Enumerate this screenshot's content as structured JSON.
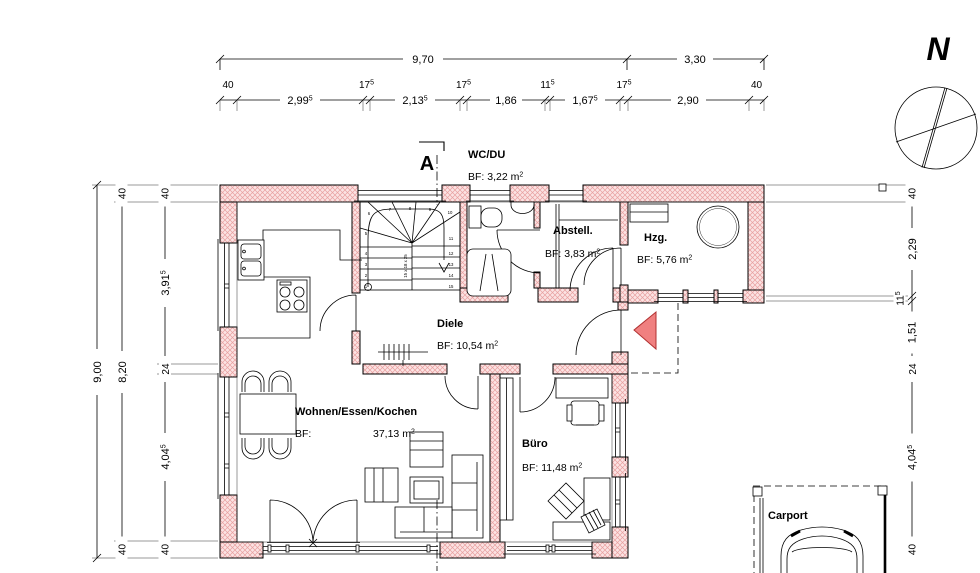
{
  "compass": {
    "label": "N"
  },
  "section": {
    "label": "A"
  },
  "colors": {
    "wall_fill": "#fbe3e3",
    "wall_hatch": "#e8a0a0",
    "accent_red": "#f08080",
    "line": "#000000"
  },
  "dims": {
    "top_total": [
      {
        "t": "9,70"
      },
      {
        "t": "3,30"
      }
    ],
    "top_small": [
      {
        "t": "40"
      },
      {
        "t": "17",
        "s": "5"
      },
      {
        "t": "17",
        "s": "5"
      },
      {
        "t": "11",
        "s": "5"
      },
      {
        "t": "17",
        "s": "5"
      },
      {
        "t": "40"
      }
    ],
    "top_inline": [
      {
        "t": "2,99",
        "s": "5"
      },
      {
        "t": "2,13",
        "s": "5"
      },
      {
        "t": "1,86"
      },
      {
        "t": "1,67",
        "s": "5"
      },
      {
        "t": "2,90"
      }
    ],
    "left_total": {
      "t": "9,00"
    },
    "left_mid": [
      {
        "t": "40"
      },
      {
        "t": "8,20"
      },
      {
        "t": "40"
      }
    ],
    "left_inner": [
      {
        "t": "40"
      },
      {
        "t": "3,91",
        "s": "5"
      },
      {
        "t": "24"
      },
      {
        "t": "4,04",
        "s": "5"
      },
      {
        "t": "40"
      }
    ],
    "right": [
      {
        "t": "40"
      },
      {
        "t": "2,29"
      },
      {
        "t": "11",
        "s": "5"
      },
      {
        "t": "1,51"
      },
      {
        "t": "24"
      },
      {
        "t": "4,04",
        "s": "5"
      },
      {
        "t": "40"
      }
    ]
  },
  "rooms": {
    "wc": {
      "name": "WC/DU",
      "bf": "BF: 3,22 m",
      "sup": "2"
    },
    "abstell": {
      "name": "Abstell.",
      "bf": "BF: 3,83 m",
      "sup": "2"
    },
    "hzg": {
      "name": "Hzg.",
      "bf": "BF: 5,76 m",
      "sup": "2"
    },
    "diele": {
      "name": "Diele",
      "bf": "BF: 10,54 m",
      "sup": "2"
    },
    "wohnen": {
      "name": "Wohnen/Essen/Kochen",
      "bf_prefix": "BF:",
      "area": "37,13 m",
      "sup": "2"
    },
    "buero": {
      "name": "Büro",
      "bf": "BF: 11,48 m",
      "sup": "2"
    },
    "carport": {
      "name": "Carport"
    }
  },
  "stairs": {
    "numbers": [
      "1",
      "2",
      "3",
      "4",
      "5",
      "6",
      "7",
      "8",
      "9",
      "10",
      "11",
      "12",
      "13",
      "14",
      "15"
    ],
    "note": "15 x 18 x 25"
  }
}
